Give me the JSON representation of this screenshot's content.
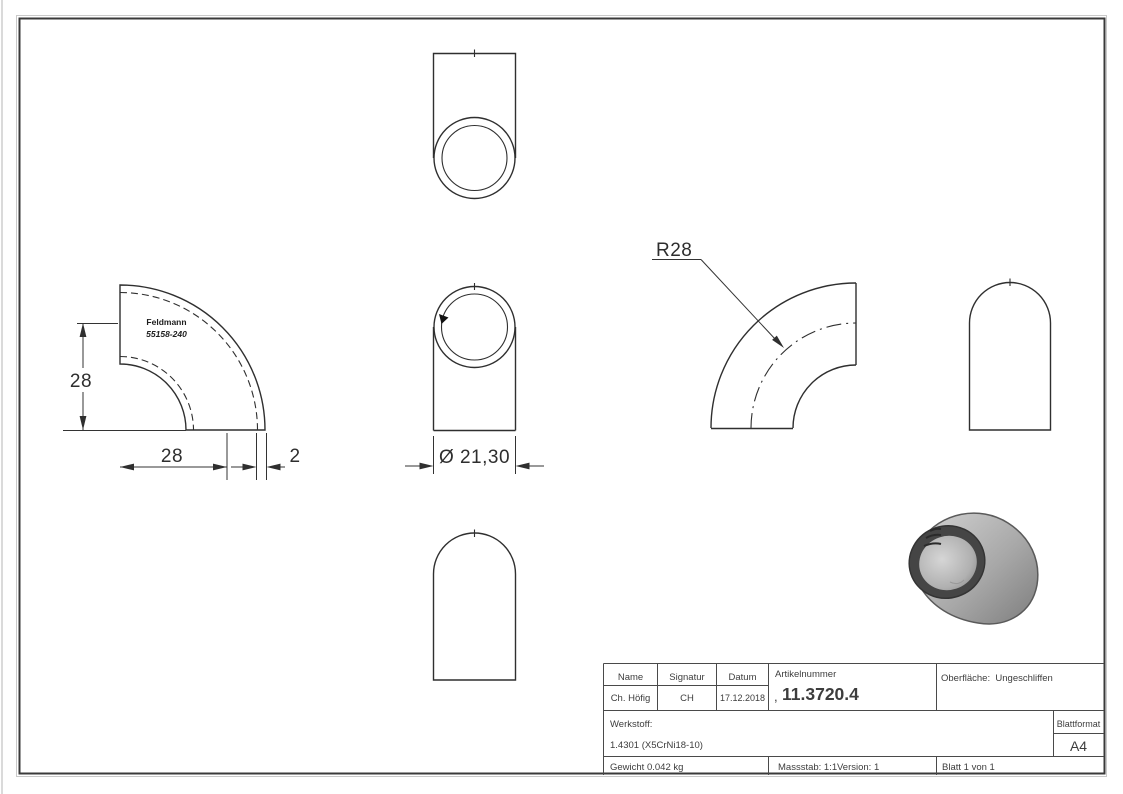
{
  "views": {
    "front": {
      "brand": "Feldmann",
      "part_code": "55158-240"
    },
    "dimensions": {
      "height": "28",
      "radius_horizontal": "28",
      "wall": "2",
      "diameter": "Ø 21,30",
      "bend_radius": "R28"
    }
  },
  "title_block": {
    "headers": {
      "name": "Name",
      "signatur": "Signatur",
      "datum": "Datum",
      "artikelnummer": "Artikelnummer",
      "oberflaeche": "Oberfläche:  Ungeschliffen",
      "werkstoff": "Werkstoff:",
      "blattformat": "Blattformat"
    },
    "values": {
      "name": "Ch. Höfig",
      "signatur": "CH",
      "datum": "17.12.2018",
      "artikelnummer_prefix": ",",
      "artikelnummer": "11.3720.4",
      "werkstoff": "1.4301 (X5CrNi18-10)",
      "blattformat": "A4",
      "gewicht": "Gewicht 0.042 kg",
      "massstab": "Massstab: 1:1",
      "version": "Version: 1",
      "blatt": "Blatt 1 von 1"
    }
  },
  "colors": {
    "line": "#2f2f2f",
    "table_line": "#4a4a4a",
    "rim": "#454545",
    "metal_light": "#cfcfcf",
    "metal_dark": "#7d7d7d"
  }
}
